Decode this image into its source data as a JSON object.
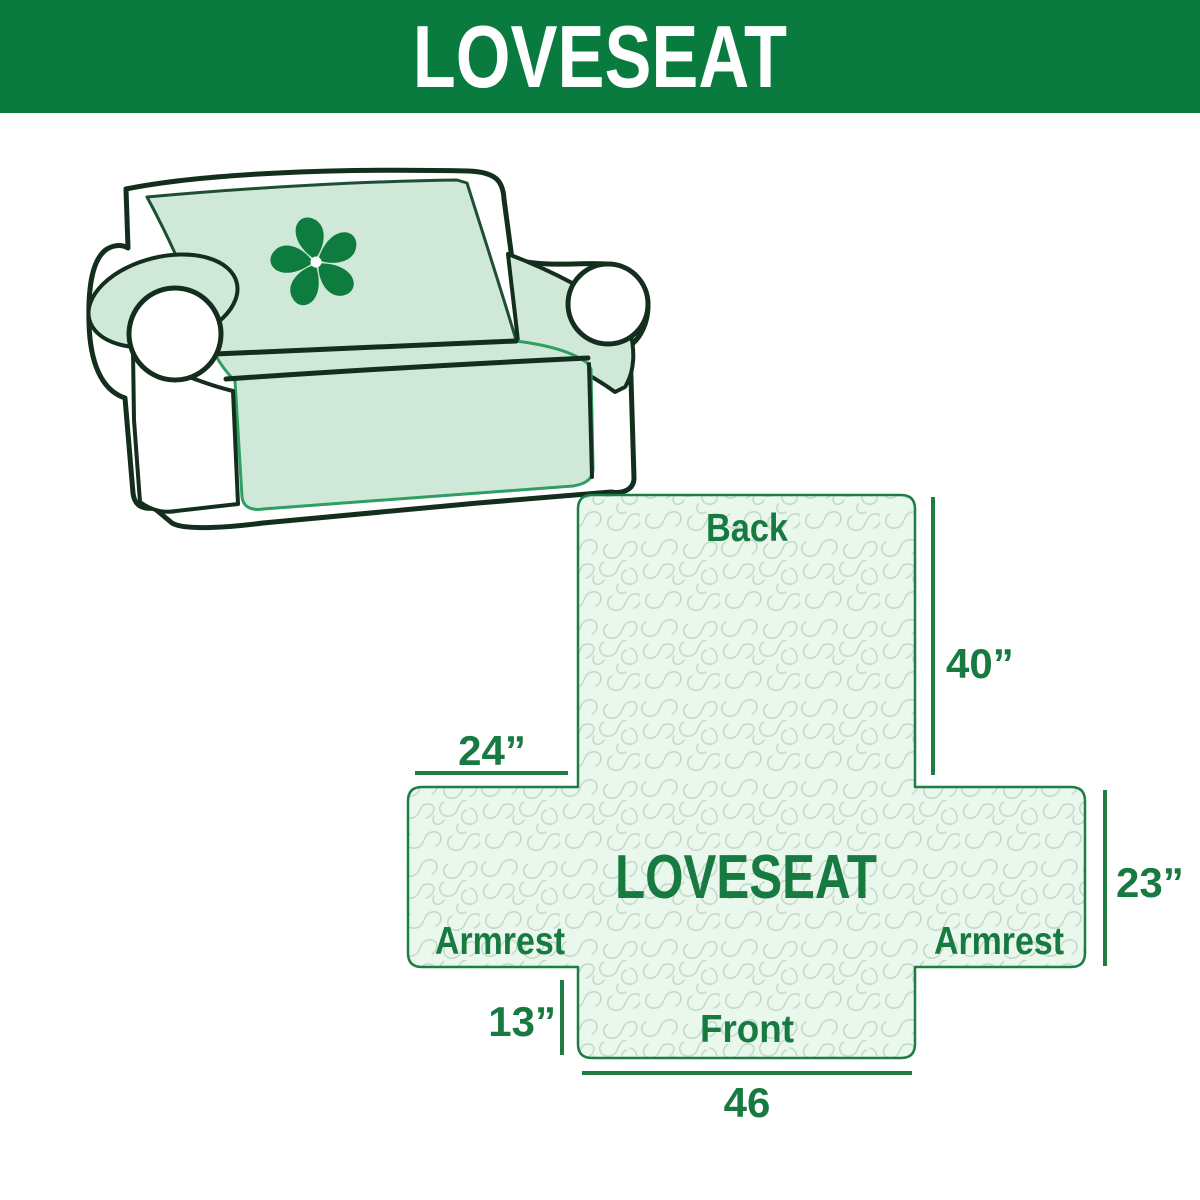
{
  "banner": {
    "title": "LOVESEAT",
    "bg_color": "#0a7b3e",
    "text_color": "#ffffff"
  },
  "illustration": {
    "description": "loveseat sofa with mint-green protective cover",
    "logo_icon": "pinwheel-fan-icon",
    "logo_color": "#0f7c3f",
    "cover_color": "#cfe8d7",
    "outline_color": "#142e1e"
  },
  "diagram": {
    "center_label": "LOVESEAT",
    "labels": {
      "back": "Back",
      "front": "Front",
      "armrest_left": "Armrest",
      "armrest_right": "Armrest"
    },
    "measurements": {
      "back_height": "40”",
      "armrest_width": "24”",
      "armrest_height": "23”",
      "front_drop": "13”",
      "front_width": "46"
    },
    "fill_color": "#e9f7ec",
    "outline_color": "#1e7c45",
    "text_color": "#177a40",
    "pattern_color": "#c3d8c8"
  }
}
